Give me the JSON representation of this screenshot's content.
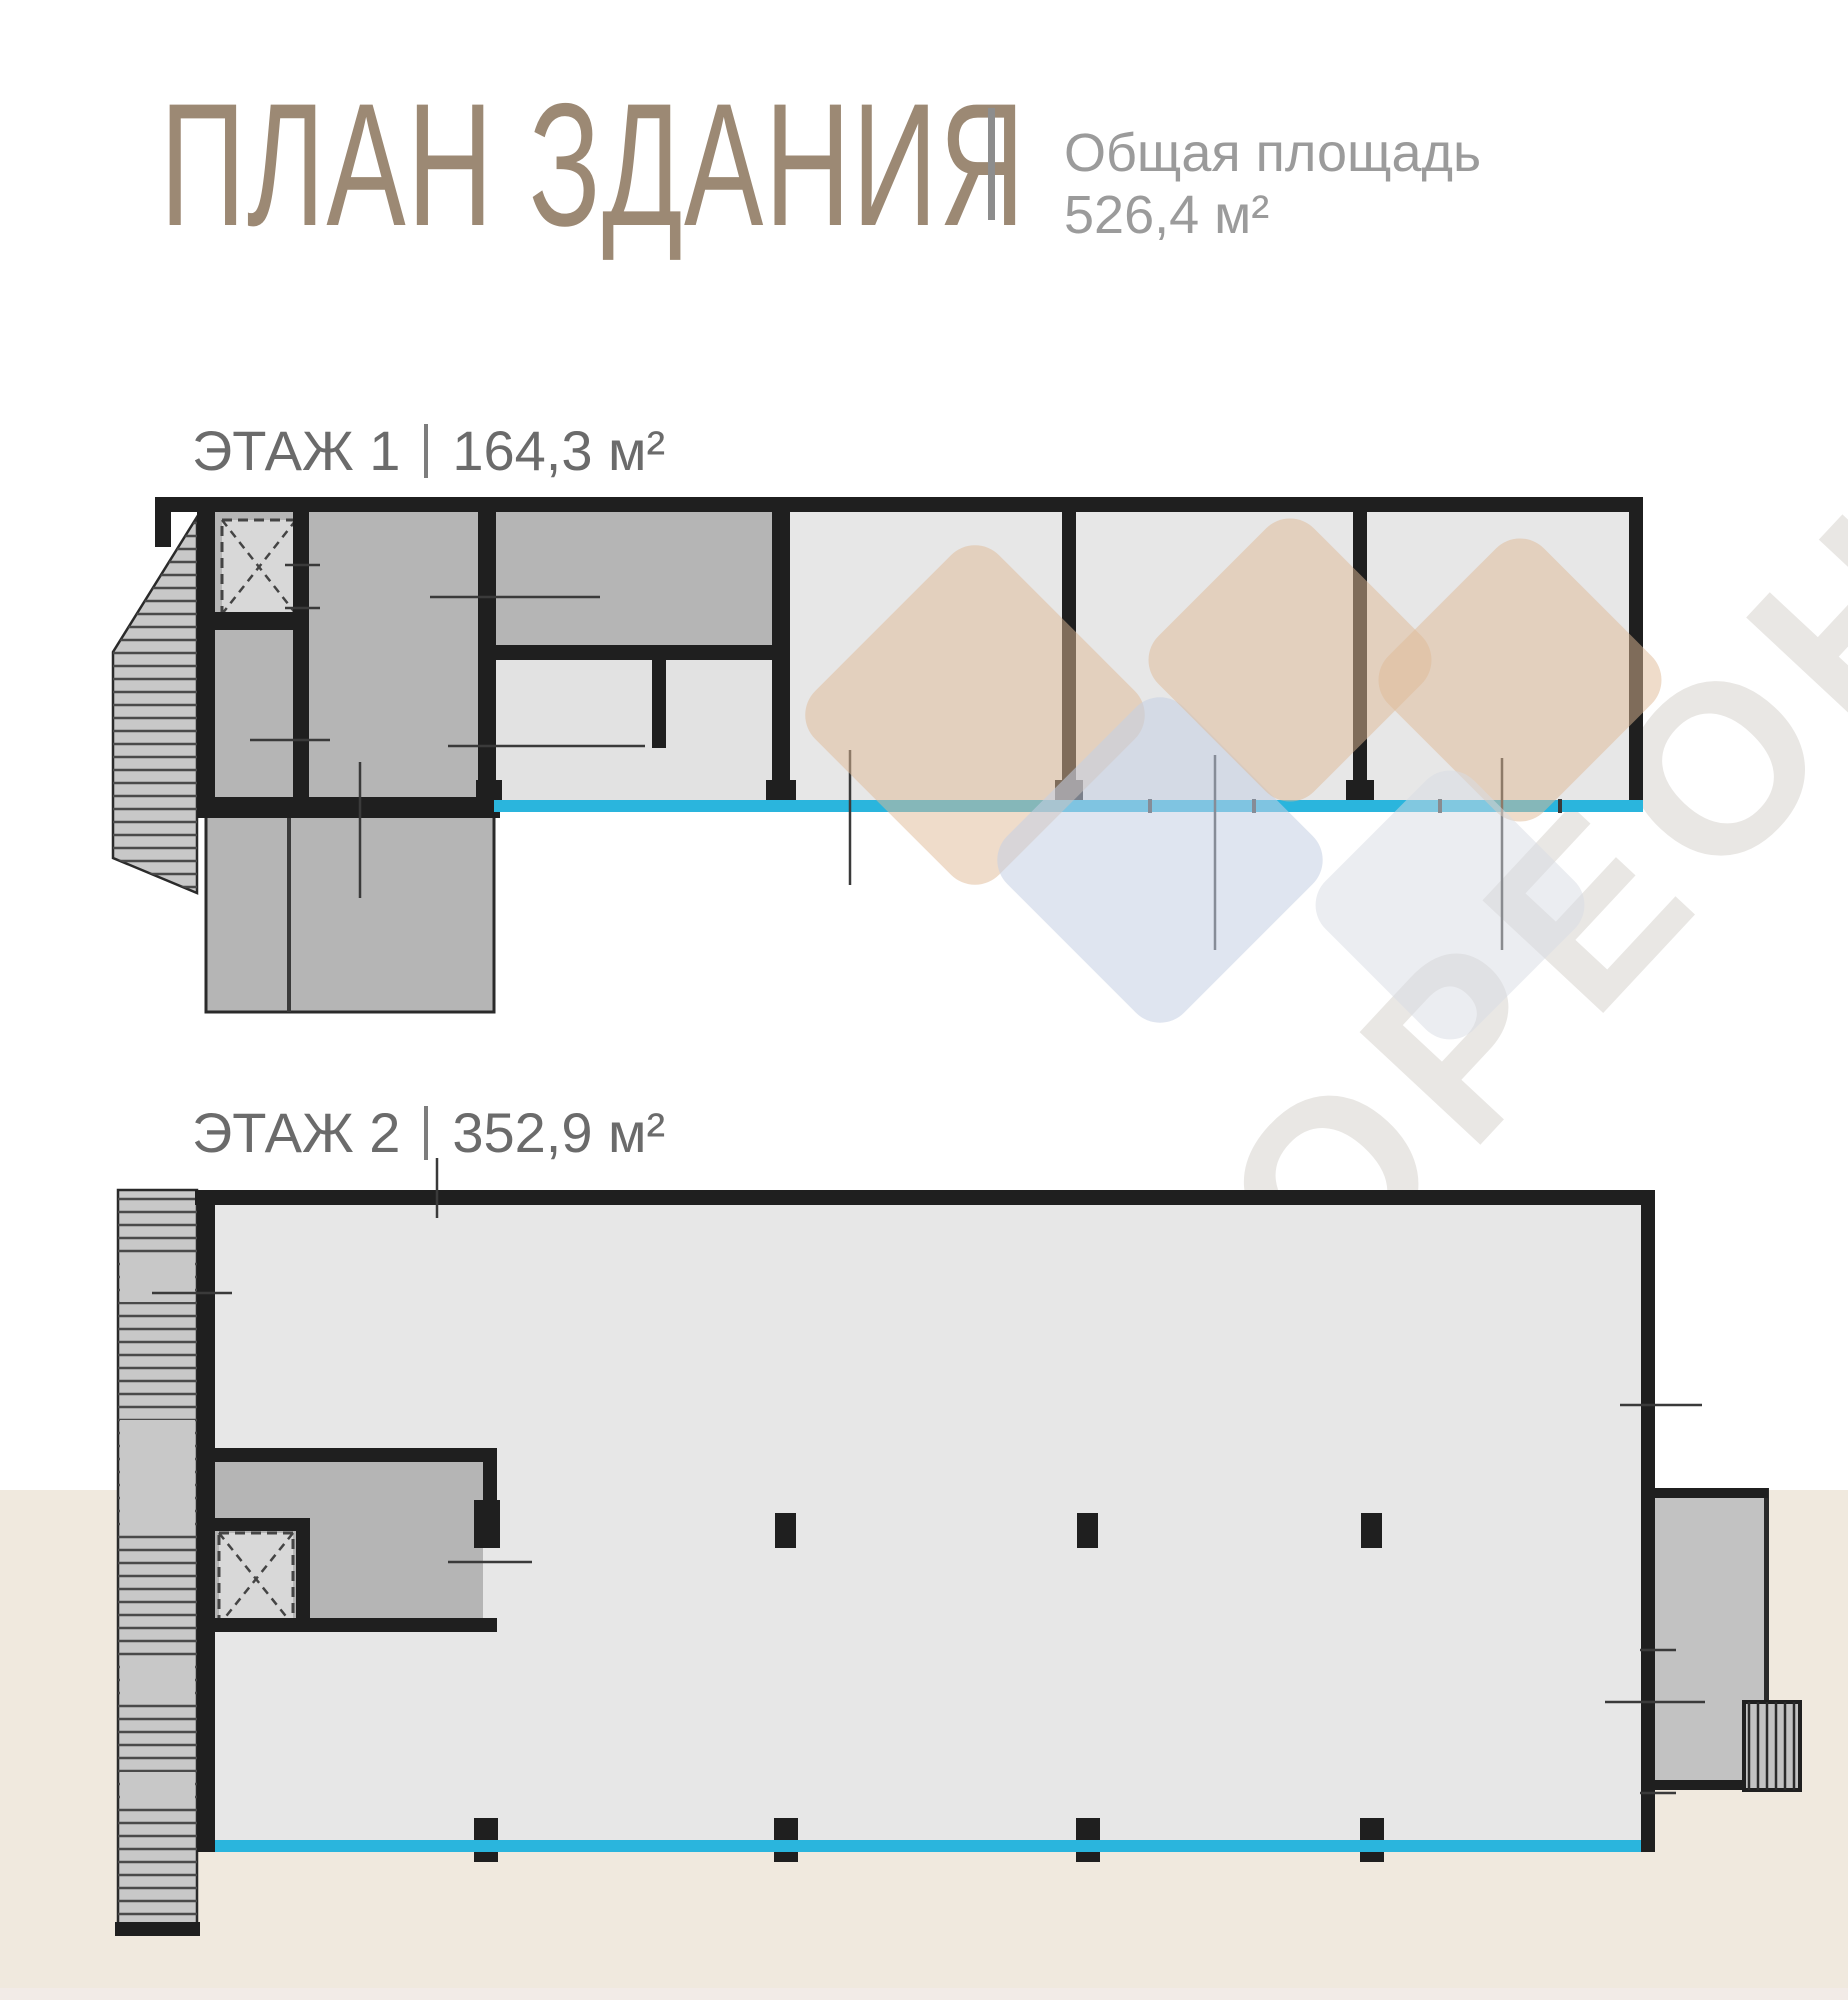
{
  "header": {
    "title": "ПЛАН ЗДАНИЯ",
    "total_area_label": "Общая площадь",
    "total_area_value": "526,4 м²"
  },
  "floors": [
    {
      "label": "ЭТАЖ 1",
      "area": "164,3 м²"
    },
    {
      "label": "ЭТАЖ 2",
      "area": "352,9 м²"
    }
  ],
  "watermark": {
    "text": "МОРЕОН"
  },
  "theme": {
    "wall": "#1f1f1f",
    "room_dark": "#b5b5b5",
    "room_mid": "#e2e2e2",
    "room_light": "#e7e7e7",
    "stair_fill": "#c8c8c8",
    "hatch": "#4a4a4a",
    "window_line": "#2ab5dd",
    "elevator_fill": "#d8d8d8",
    "annex_fill": "#c2c2c2",
    "beige_band": "#f0e9de",
    "title": "#9c8974",
    "subtitle": "#9b9b9b",
    "floor_label": "#6b6b6b",
    "divider": "#8d8d8d",
    "watermark_text": "#e9e7e4",
    "diamond_beige": "rgba(224,186,150,0.5)",
    "diamond_blue": "rgba(196,208,228,0.55)",
    "diamond_gray": "rgba(216,220,228,0.5)"
  }
}
